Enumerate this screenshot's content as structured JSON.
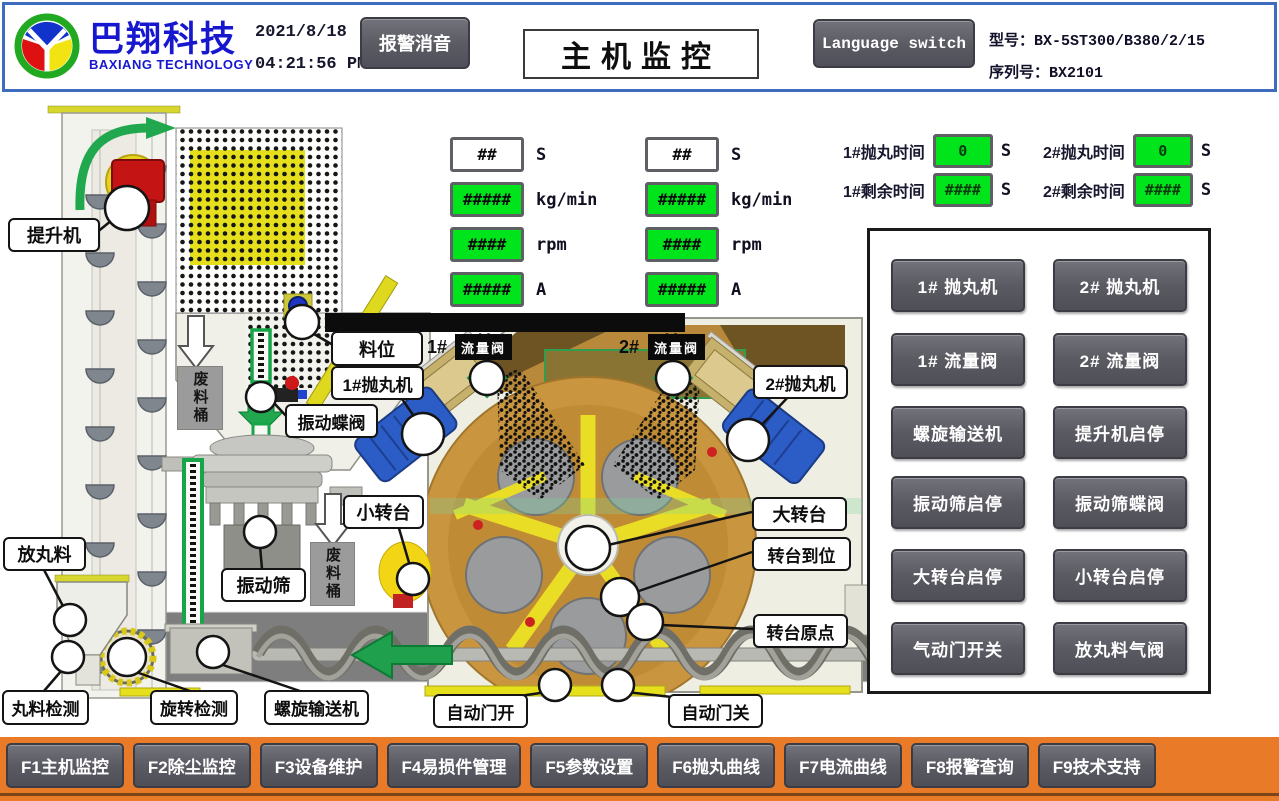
{
  "header": {
    "brand_cn": "巴翔科技",
    "brand_en": "BAXIANG TECHNOLOGY",
    "date": "2021/8/18",
    "time": "04:21:56 PM",
    "mute_button": "报警消音",
    "page_title": "主机监控",
    "language_button": "Language switch",
    "model": "型号：BX-5ST300/B380/2/15",
    "serial": "序列号：BX2101"
  },
  "meters": {
    "left": [
      {
        "value": "##",
        "unit": "S"
      },
      {
        "value": "#####",
        "unit": "kg/min"
      },
      {
        "value": "####",
        "unit": "rpm"
      },
      {
        "value": "#####",
        "unit": "A"
      }
    ],
    "right": [
      {
        "value": "##",
        "unit": "S"
      },
      {
        "value": "#####",
        "unit": "kg/min"
      },
      {
        "value": "####",
        "unit": "rpm"
      },
      {
        "value": "#####",
        "unit": "A"
      }
    ]
  },
  "timers": [
    {
      "label": "1#抛丸时间",
      "value": "0",
      "unit": "S"
    },
    {
      "label": "2#抛丸时间",
      "value": "0",
      "unit": "S"
    },
    {
      "label": "1#剩余时间",
      "value": "####",
      "unit": "S"
    },
    {
      "label": "2#剩余时间",
      "value": "####",
      "unit": "S"
    }
  ],
  "control_panel": {
    "buttons": [
      "1# 抛丸机",
      "2# 抛丸机",
      "1# 流量阀",
      "2# 流量阀",
      "螺旋输送机",
      "提升机启停",
      "振动筛启停",
      "振动筛蝶阀",
      "大转台启停",
      "小转台启停",
      "气动门开关",
      "放丸料气阀"
    ]
  },
  "diagram": {
    "labels": {
      "elevator": "提升机",
      "material_level": "料位",
      "blaster1": "1#抛丸机",
      "blaster2": "2#抛丸机",
      "vibrating_valve": "振动蝶阀",
      "vibrating_sieve": "振动筛",
      "small_turntable": "小转台",
      "waste_bin": "废料桶",
      "shot_release": "放丸料",
      "shot_detect": "丸料检测",
      "rotation_detect": "旋转检测",
      "screw_conveyor": "螺旋输送机",
      "door_open": "自动门开",
      "door_close": "自动门关",
      "big_turntable": "大转台",
      "turntable_in_place": "转台到位",
      "turntable_origin": "转台原点",
      "flow_valve": "流量阀",
      "flow1_no": "1#",
      "flow2_no": "2#"
    }
  },
  "function_keys": [
    "F1主机监控",
    "F2除尘监控",
    "F3设备维护",
    "F4易损件管理",
    "F5参数设置",
    "F6抛丸曲线",
    "F7电流曲线",
    "F8报警查询",
    "F9技术支持"
  ],
  "colors": {
    "display_green": "#00e41c",
    "bar_orange": "#e87a28",
    "header_blue": "#3e6cbf",
    "button_gray": "#5a5a63",
    "arrow_green": "#1fa04c"
  }
}
